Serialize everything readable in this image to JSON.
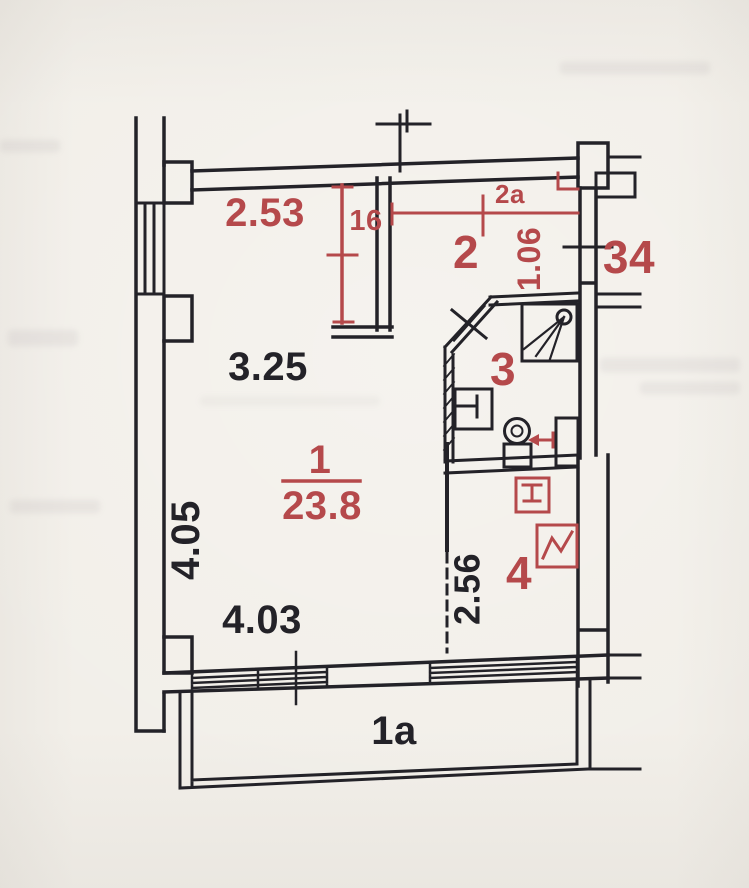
{
  "plan": {
    "colors": {
      "paper": "#f2efe9",
      "ink": "#232228",
      "red": "#b5494b"
    },
    "rooms": [
      {
        "key": "living",
        "number": "1",
        "area": "23.8"
      },
      {
        "key": "niche",
        "number": "2"
      },
      {
        "key": "niche-2a",
        "number": "2a"
      },
      {
        "key": "bathroom",
        "number": "3"
      },
      {
        "key": "hall",
        "number": "4"
      },
      {
        "key": "balcony",
        "number": "1a"
      }
    ],
    "dimensions": {
      "top_width": "2.53",
      "shaft_width": "16",
      "niche_height": "1.06",
      "wall_upper": "3.25",
      "side_height": "4.05",
      "hall_height": "2.56",
      "bottom_width": "4.03"
    },
    "neighbor": {
      "unit_label": "34"
    }
  }
}
